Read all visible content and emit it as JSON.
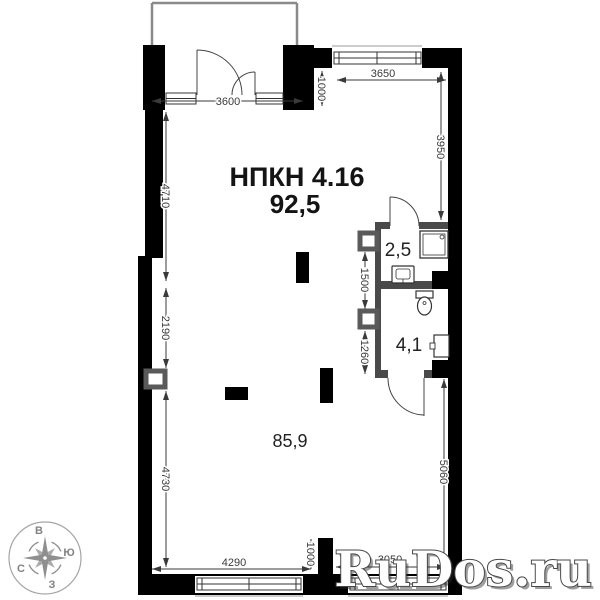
{
  "plan": {
    "unit_label": "НПКН 4.16",
    "total_area": "92,5",
    "main_area": "85,9",
    "bath_small_area": "2,5",
    "bath_large_area": "4,1",
    "dims": {
      "top_left": "3600",
      "top_right": "3650",
      "top_offset": "1000",
      "right_upper": "3950",
      "left_upper": "4710",
      "left_mid": "2190",
      "left_lower": "4730",
      "bath_upper": "1500",
      "bath_lower": "1260",
      "right_lower": "5060",
      "bottom_left": "4290",
      "bottom_offset": "1000",
      "bottom_right": "3050"
    },
    "compass": {
      "top": "В",
      "right": "Ю",
      "left": "С",
      "bottom": "З"
    },
    "watermark": "RuDos.ru",
    "colors": {
      "wall": "#000000",
      "partition": "#4a4a4a",
      "dimension": "#3a3a3a",
      "compass": "#8f8f8f",
      "watermark_fill": "#ffffff",
      "watermark_outline": "#474747"
    }
  }
}
